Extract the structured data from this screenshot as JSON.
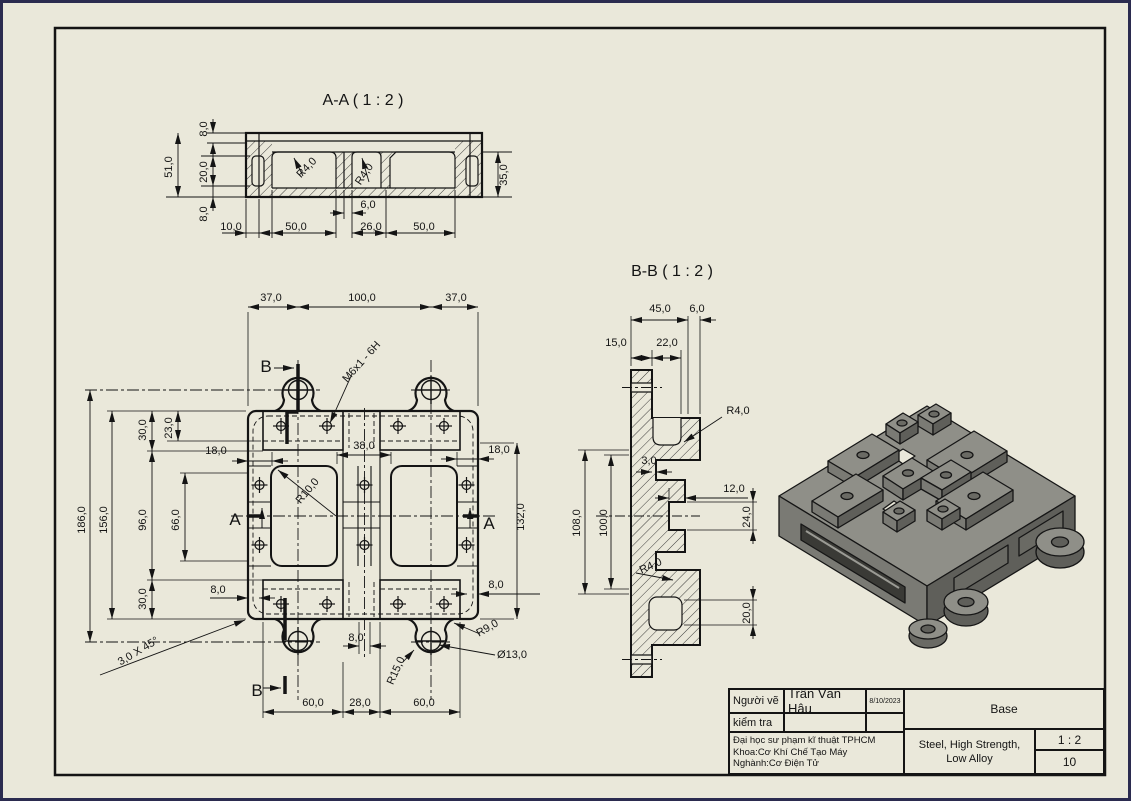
{
  "sheet": {
    "background_color": "#eae8da",
    "outer_border_color": "#2b2b4f",
    "frame_color": "#141414",
    "hatch_color": "#2a2a2a"
  },
  "views": {
    "section_aa": {
      "title": "A-A ( 1 : 2 )"
    },
    "section_bb": {
      "title": "B-B ( 1 : 2 )"
    },
    "main_view": {
      "cut_labels": [
        "A",
        "B"
      ]
    },
    "iso_view": {
      "top_color": "#8f8f88",
      "left_color": "#7a7a74",
      "right_color": "#5f5f5a",
      "slot_color": "#3a3a36",
      "outline_color": "#161616"
    }
  },
  "annotations": [
    {
      "t": "A-A ( 1 : 2 )",
      "x": 363,
      "y": 105,
      "s": 16
    },
    {
      "t": "8,0",
      "x": 207,
      "y": 129,
      "r": -90
    },
    {
      "t": "51,0",
      "x": 172,
      "y": 167,
      "r": -90
    },
    {
      "t": "20,0",
      "x": 207,
      "y": 172,
      "r": -90
    },
    {
      "t": "8,0",
      "x": 207,
      "y": 214,
      "r": -90
    },
    {
      "t": "35,0",
      "x": 507,
      "y": 175,
      "r": -90
    },
    {
      "t": "R4,0",
      "x": 309,
      "y": 170,
      "r": -46
    },
    {
      "t": "R4,0",
      "x": 367,
      "y": 176,
      "r": -56
    },
    {
      "t": "6,0",
      "x": 368,
      "y": 208
    },
    {
      "t": "10,0",
      "x": 231,
      "y": 230
    },
    {
      "t": "50,0",
      "x": 296,
      "y": 230
    },
    {
      "t": "26,0",
      "x": 371,
      "y": 230
    },
    {
      "t": "50,0",
      "x": 424,
      "y": 230
    },
    {
      "t": "B-B ( 1 : 2 )",
      "x": 672,
      "y": 276,
      "s": 16
    },
    {
      "t": "45,0",
      "x": 660,
      "y": 312
    },
    {
      "t": "6,0",
      "x": 697,
      "y": 312
    },
    {
      "t": "15,0",
      "x": 616,
      "y": 346
    },
    {
      "t": "22,0",
      "x": 667,
      "y": 346
    },
    {
      "t": "R4,0",
      "x": 738,
      "y": 414
    },
    {
      "t": "3,0",
      "x": 649,
      "y": 464
    },
    {
      "t": "12,0",
      "x": 734,
      "y": 492
    },
    {
      "t": "24,0",
      "x": 750,
      "y": 517,
      "r": -90
    },
    {
      "t": "108,0",
      "x": 580,
      "y": 523,
      "r": -90
    },
    {
      "t": "100,0",
      "x": 607,
      "y": 523,
      "r": -90
    },
    {
      "t": "R4,0",
      "x": 652,
      "y": 569,
      "r": -24
    },
    {
      "t": "20,0",
      "x": 750,
      "y": 613,
      "r": -90
    },
    {
      "t": "37,0",
      "x": 271,
      "y": 301
    },
    {
      "t": "100,0",
      "x": 362,
      "y": 301
    },
    {
      "t": "37,0",
      "x": 456,
      "y": 301
    },
    {
      "t": "B",
      "x": 266,
      "y": 372,
      "s": 17
    },
    {
      "t": "M6x1 - 6H",
      "x": 364,
      "y": 364,
      "r": -48
    },
    {
      "t": "18,0",
      "x": 216,
      "y": 454
    },
    {
      "t": "38,0",
      "x": 364,
      "y": 449
    },
    {
      "t": "18,0",
      "x": 499,
      "y": 453
    },
    {
      "t": "R10,0",
      "x": 310,
      "y": 493,
      "r": -50
    },
    {
      "t": "186,0",
      "x": 85,
      "y": 520,
      "r": -90
    },
    {
      "t": "156,0",
      "x": 107,
      "y": 520,
      "r": -90
    },
    {
      "t": "96,0",
      "x": 146,
      "y": 520,
      "r": -90
    },
    {
      "t": "66,0",
      "x": 179,
      "y": 520,
      "r": -90
    },
    {
      "t": "30,0",
      "x": 146,
      "y": 430,
      "r": -90
    },
    {
      "t": "23,0",
      "x": 172,
      "y": 428,
      "r": -90
    },
    {
      "t": "30,0",
      "x": 146,
      "y": 599,
      "r": -90
    },
    {
      "t": "8,0",
      "x": 218,
      "y": 593
    },
    {
      "t": "8,0",
      "x": 496,
      "y": 588
    },
    {
      "t": "132,0",
      "x": 524,
      "y": 517,
      "r": -90
    },
    {
      "t": "A",
      "x": 235,
      "y": 525,
      "s": 17
    },
    {
      "t": "A",
      "x": 489,
      "y": 529,
      "s": 17
    },
    {
      "t": "3,0 X 45°",
      "x": 140,
      "y": 654,
      "r": -31
    },
    {
      "t": "8,0",
      "x": 356,
      "y": 641
    },
    {
      "t": "B",
      "x": 257,
      "y": 696,
      "s": 17
    },
    {
      "t": "60,0",
      "x": 313,
      "y": 706
    },
    {
      "t": "28,0",
      "x": 360,
      "y": 706
    },
    {
      "t": "60,0",
      "x": 424,
      "y": 706
    },
    {
      "t": "R15,0",
      "x": 399,
      "y": 672,
      "r": -66
    },
    {
      "t": "R9,0",
      "x": 489,
      "y": 631,
      "r": -30
    },
    {
      "t": "Ø13,0",
      "x": 512,
      "y": 658
    }
  ],
  "title_block": {
    "drawn_by_label": "Người vẽ",
    "drawn_by": "Trần Văn Hậu",
    "date": "8/10/2023",
    "checked_label": "kiểm tra",
    "org_line1": "Đại học sư phạm kĩ thuật TPHCM",
    "org_line2": "Khoa:Cơ Khí Chế Tạo Máy",
    "org_line3": "Nghành:Cơ Điện Tử",
    "part_name": "Base",
    "material": "Steel, High Strength, Low Alloy",
    "scale": "1 : 2",
    "sheet_number": "10"
  }
}
